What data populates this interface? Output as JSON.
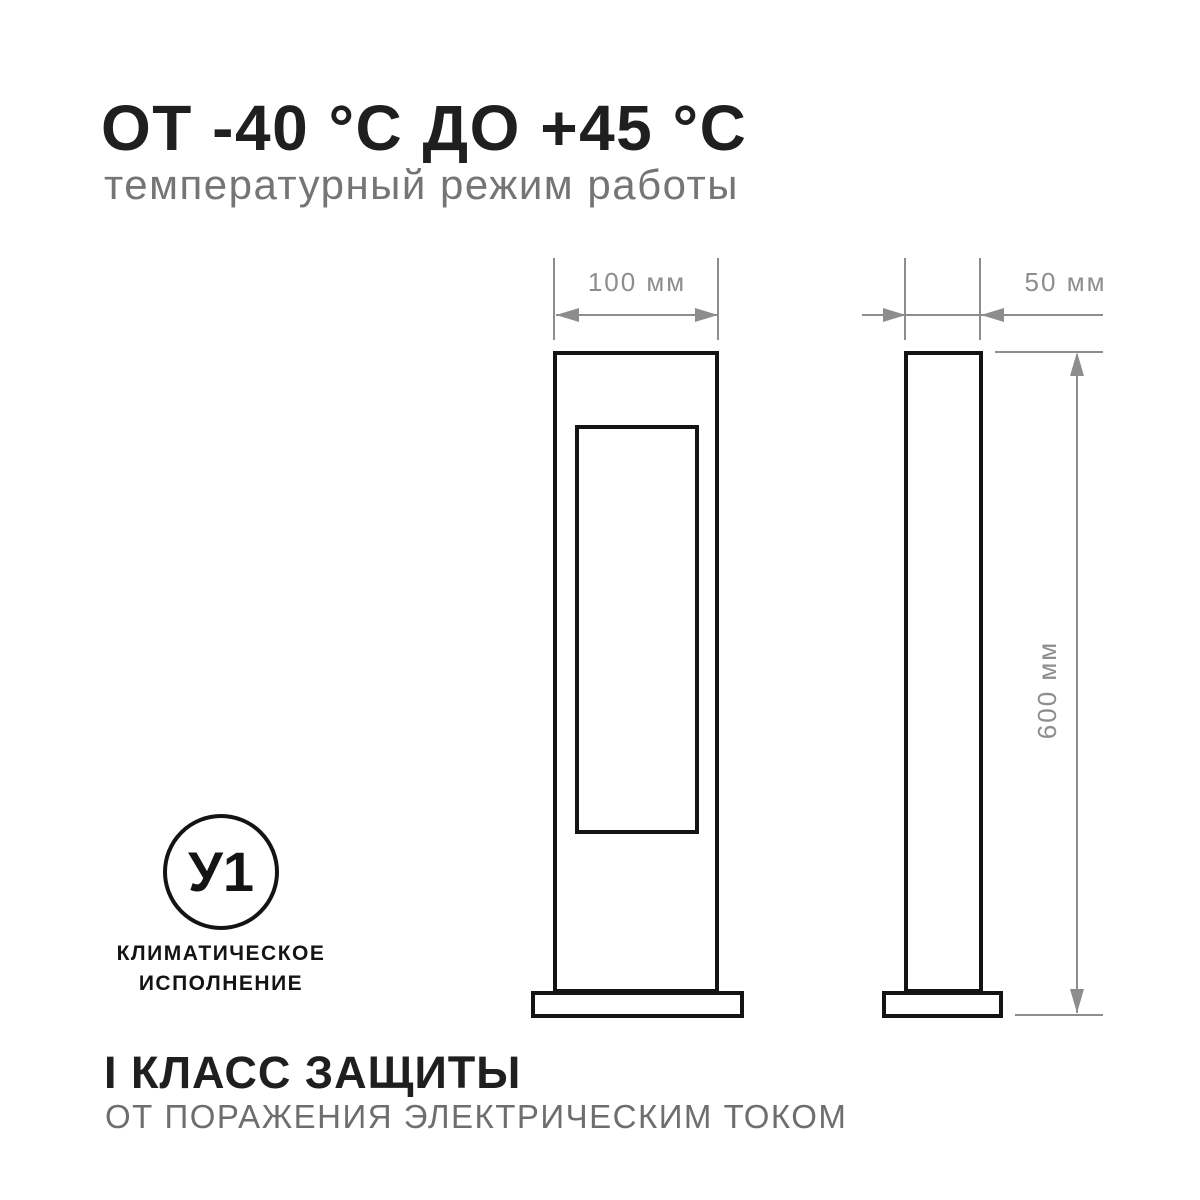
{
  "header": {
    "title": "ОТ -40 °С ДО +45 °С",
    "subtitle": "температурный режим работы"
  },
  "diagram": {
    "front_view": {
      "width_label": "100 мм"
    },
    "side_view": {
      "width_label": "50 мм",
      "height_label": "600 мм"
    }
  },
  "climate_badge": {
    "code": "У1",
    "caption_line1": "КЛИМАТИЧЕСКОЕ",
    "caption_line2": "ИСПОЛНЕНИЕ"
  },
  "footer": {
    "title": "I КЛАСС ЗАЩИТЫ",
    "subtitle": "ОТ ПОРАЖЕНИЯ ЭЛЕКТРИЧЕСКИМ ТОКОМ"
  },
  "colors": {
    "background": "#ffffff",
    "text_primary": "#1f1f1f",
    "text_secondary": "#757575",
    "footer_secondary": "#6e6e6e",
    "drawing_outline": "#141414",
    "dimension_gray": "#8d8d8d"
  }
}
